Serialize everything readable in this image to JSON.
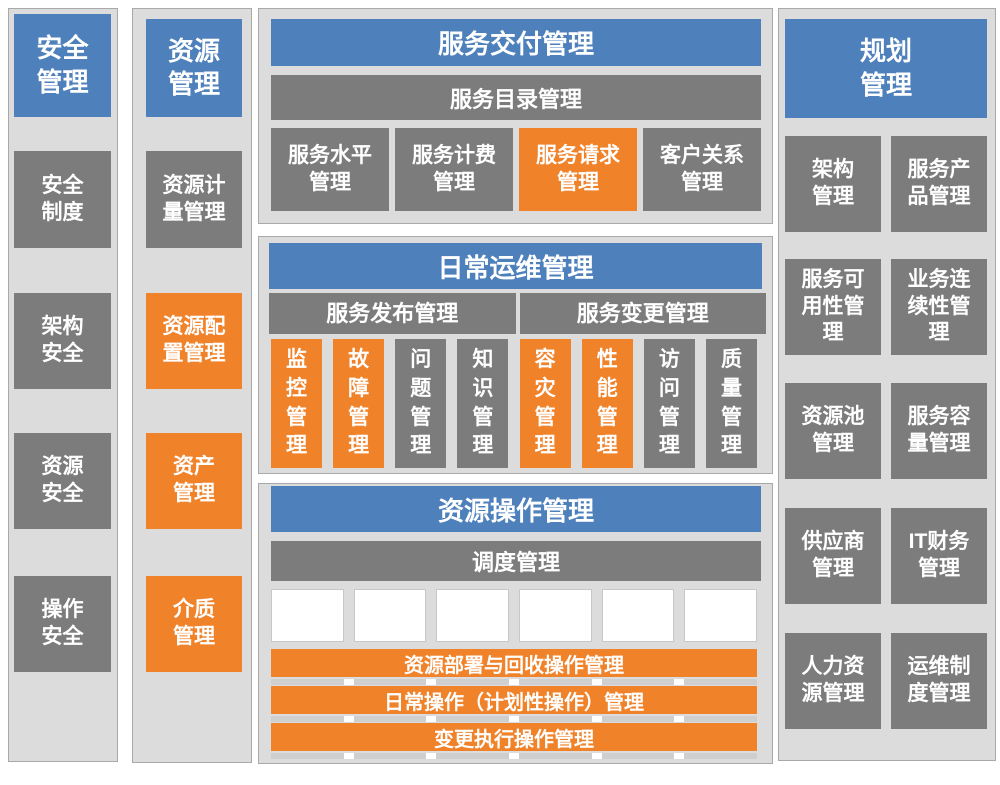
{
  "colors": {
    "blue": "#4e80bc",
    "orange": "#f0822a",
    "gray": "#7c7c7c",
    "panel": "#dcdcdc",
    "border": "#a9a9a9",
    "whiteborder": "#c8c8c8",
    "sep": "#cfcfcf",
    "dark": "#1f1f1f"
  },
  "security": {
    "header": "安全\n管理",
    "items": [
      {
        "label": "安全\n制度",
        "variant": "gray"
      },
      {
        "label": "架构\n安全",
        "variant": "gray"
      },
      {
        "label": "资源\n安全",
        "variant": "gray"
      },
      {
        "label": "操作\n安全",
        "variant": "gray"
      }
    ]
  },
  "resource": {
    "header": "资源\n管理",
    "items": [
      {
        "label": "资源计\n量管理",
        "variant": "gray"
      },
      {
        "label": "资源配\n置管理",
        "variant": "orange"
      },
      {
        "label": "资产\n管理",
        "variant": "orange"
      },
      {
        "label": "介质\n管理",
        "variant": "orange"
      }
    ]
  },
  "delivery": {
    "header": "服务交付管理",
    "catalog": "服务目录管理",
    "items": [
      {
        "label": "服务水平\n管理",
        "variant": "gray"
      },
      {
        "label": "服务计费\n管理",
        "variant": "gray"
      },
      {
        "label": "服务请求\n管理",
        "variant": "orange"
      },
      {
        "label": "客户关系\n管理",
        "variant": "gray"
      }
    ]
  },
  "daily": {
    "header": "日常运维管理",
    "groups": [
      {
        "label": "服务发布管理"
      },
      {
        "label": "服务变更管理"
      }
    ],
    "items": [
      {
        "label": "监\n控\n管\n理",
        "variant": "orange"
      },
      {
        "label": "故\n障\n管\n理",
        "variant": "orange"
      },
      {
        "label": "问\n题\n管\n理",
        "variant": "gray"
      },
      {
        "label": "知\n识\n管\n理",
        "variant": "gray"
      },
      {
        "label": "容\n灾\n管\n理",
        "variant": "orange"
      },
      {
        "label": "性\n能\n管\n理",
        "variant": "orange"
      },
      {
        "label": "访\n问\n管\n理",
        "variant": "gray"
      },
      {
        "label": "质\n量\n管\n理",
        "variant": "gray"
      }
    ]
  },
  "resops": {
    "header": "资源操作管理",
    "scheduling": "调度管理",
    "resources": [
      {
        "label": "应用\n数据"
      },
      {
        "label": "平台\n软件"
      },
      {
        "label": "计算\n资源"
      },
      {
        "label": "存储\n资源"
      },
      {
        "label": "网络\n资源"
      },
      {
        "label": "机房\n资源"
      }
    ],
    "bars": [
      {
        "label": "资源部署与回收操作管理"
      },
      {
        "label": "日常操作（计划性操作）管理"
      },
      {
        "label": "变更执行操作管理"
      }
    ]
  },
  "planning": {
    "header": "规划\n管理",
    "items": [
      {
        "label": "架构\n管理"
      },
      {
        "label": "服务产\n品管理"
      },
      {
        "label": "服务可\n用性管\n理"
      },
      {
        "label": "业务连\n续性管\n理"
      },
      {
        "label": "资源池\n管理"
      },
      {
        "label": "服务容\n量管理"
      },
      {
        "label": "供应商\n管理"
      },
      {
        "label": "IT财务\n管理"
      },
      {
        "label": "人力资\n源管理"
      },
      {
        "label": "运维制\n度管理"
      }
    ]
  }
}
